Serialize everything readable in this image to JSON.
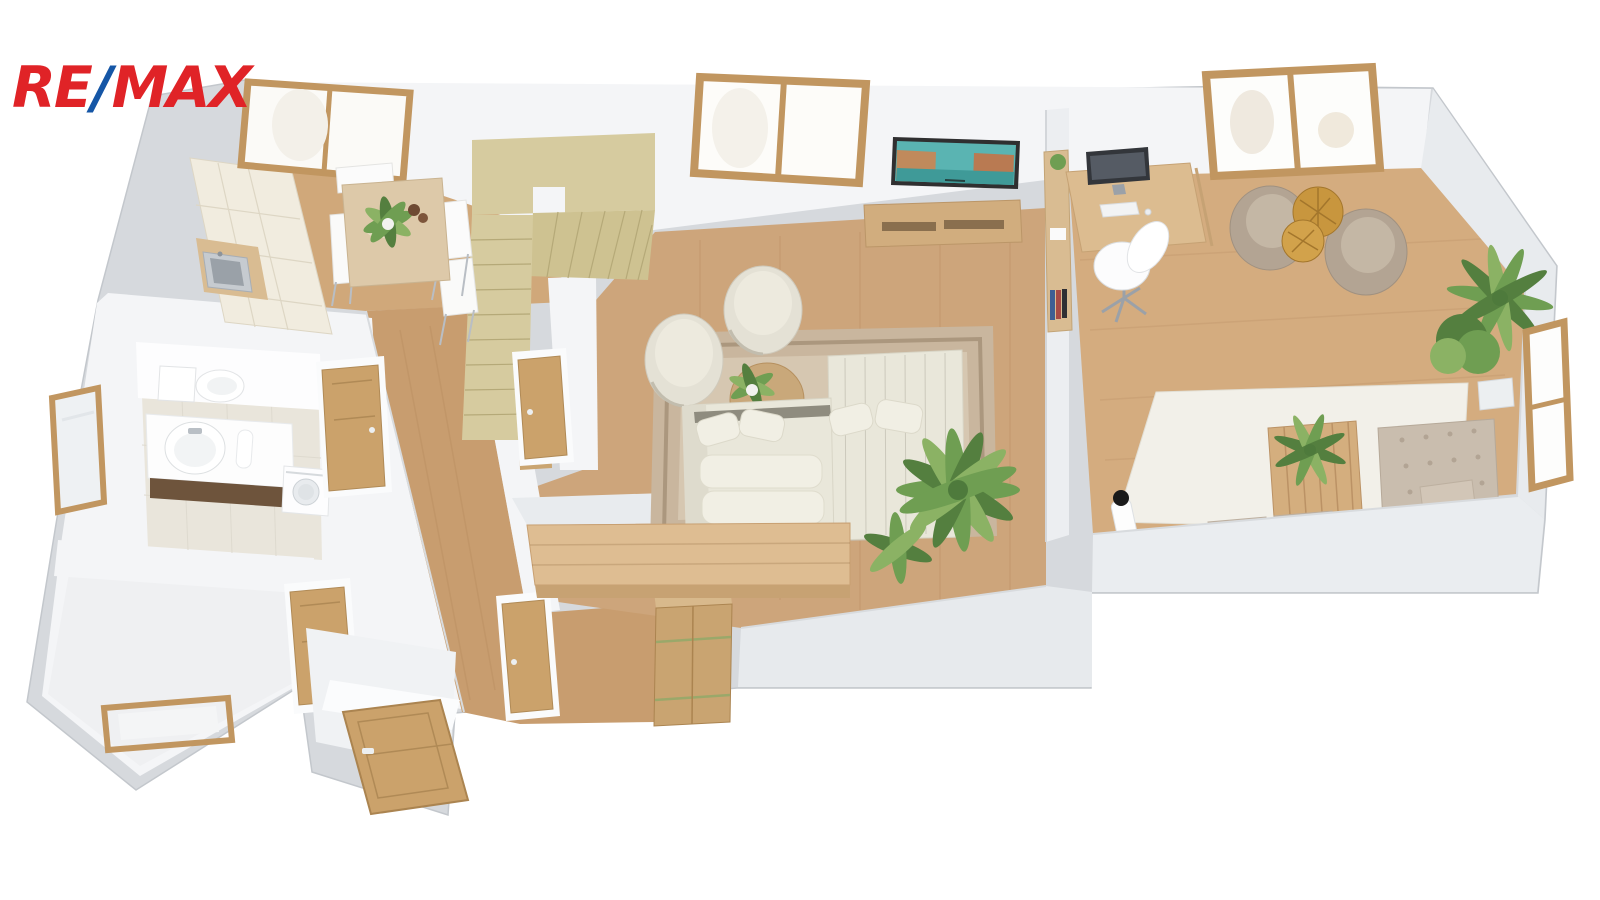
{
  "logo": {
    "re": "RE",
    "slash": "/",
    "max": "MAX",
    "red": "#E02327",
    "blue": "#1556A6"
  },
  "palette": {
    "wall_side": "#d6d9dd",
    "wall_edge": "#c3c7cc",
    "wall_white": "#f4f5f7",
    "wall_shade": "#e8ebee",
    "wall_band": "#eceef1",
    "floor_living": "#cda57b",
    "floor_study": "#d4ac7f",
    "floor_kitchen": "#d0a87a",
    "floor_hall": "#c89d6f",
    "floor_tile": "#e9e5db",
    "floor_light": "#eff0f2",
    "stairs": "#d6cb9f",
    "stairs_dark": "#cec291",
    "wood_frame": "#c19660",
    "door_wood": "#cba26b",
    "island": "#debd92",
    "island_front": "#c7a273",
    "cabinet_cream": "#f1ecdf",
    "counter": "#d9bc92",
    "sofa": "#e9e7da",
    "sofa_shadow": "#dedbcd",
    "cushion": "#f1efe4",
    "chair_cream": "#e4e1d5",
    "chair_cream_light": "#edeade",
    "taupe": "#b3a493",
    "taupe_light": "#c4b7a5",
    "rug": "#c9b69e",
    "rug_border": "#ab977e",
    "rug_field": "#d6c7b1",
    "rug_white": "#f2f0e9",
    "travertine": "#ddc9a9",
    "gold": "#c8963e",
    "gold_light": "#d2a24b",
    "green": "#6f9e52",
    "green_dark": "#547f3f",
    "green_light": "#8bb264",
    "painting_teal": "#5ab4b2",
    "painting_water": "#3f9a98",
    "painting_bldg": "#c08a5c",
    "frame_dark": "#2f2f30",
    "tufted": "#c9bdae",
    "tufted_dark": "#b2a494",
    "pure_white": "#fdfdfe",
    "metal": "#b9bfc5",
    "dark_wood": "#6e543c",
    "monitor": "#33363b"
  },
  "scene": {
    "type": "3d-floor-plan-render",
    "rooms": [
      {
        "name": "kitchen",
        "items": [
          "kitchen-cabinets",
          "kitchen-sink",
          "kitchen-window",
          "dining-table",
          "dining-chairs",
          "table-plant"
        ]
      },
      {
        "name": "living-room",
        "items": [
          "corner-sofa",
          "round-lounge-chairs",
          "round-coffee-table",
          "area-rug",
          "tv-console",
          "venice-wall-art",
          "window",
          "palm-plant",
          "kitchen-island-counter"
        ]
      },
      {
        "name": "study-room",
        "items": [
          "desk",
          "monitor",
          "office-chair",
          "bookshelf",
          "taupe-armchairs",
          "gold-side-table",
          "white-rug",
          "slat-coffee-table",
          "tufted-daybed",
          "corner-plants",
          "floor-lamp",
          "windows"
        ]
      },
      {
        "name": "bathroom",
        "items": [
          "toilet",
          "vanity-with-sink",
          "washing-machine",
          "wall-mirror",
          "tiled-floor"
        ]
      },
      {
        "name": "hallway",
        "items": [
          "interior-doors",
          "open-entrance-door",
          "wardrobe-cabinet"
        ]
      },
      {
        "name": "staircase",
        "items": [
          "upper-landing",
          "winder-steps",
          "straight-flight",
          "newel-post"
        ]
      },
      {
        "name": "storage-room",
        "items": [
          "wooden-frame"
        ]
      }
    ]
  }
}
